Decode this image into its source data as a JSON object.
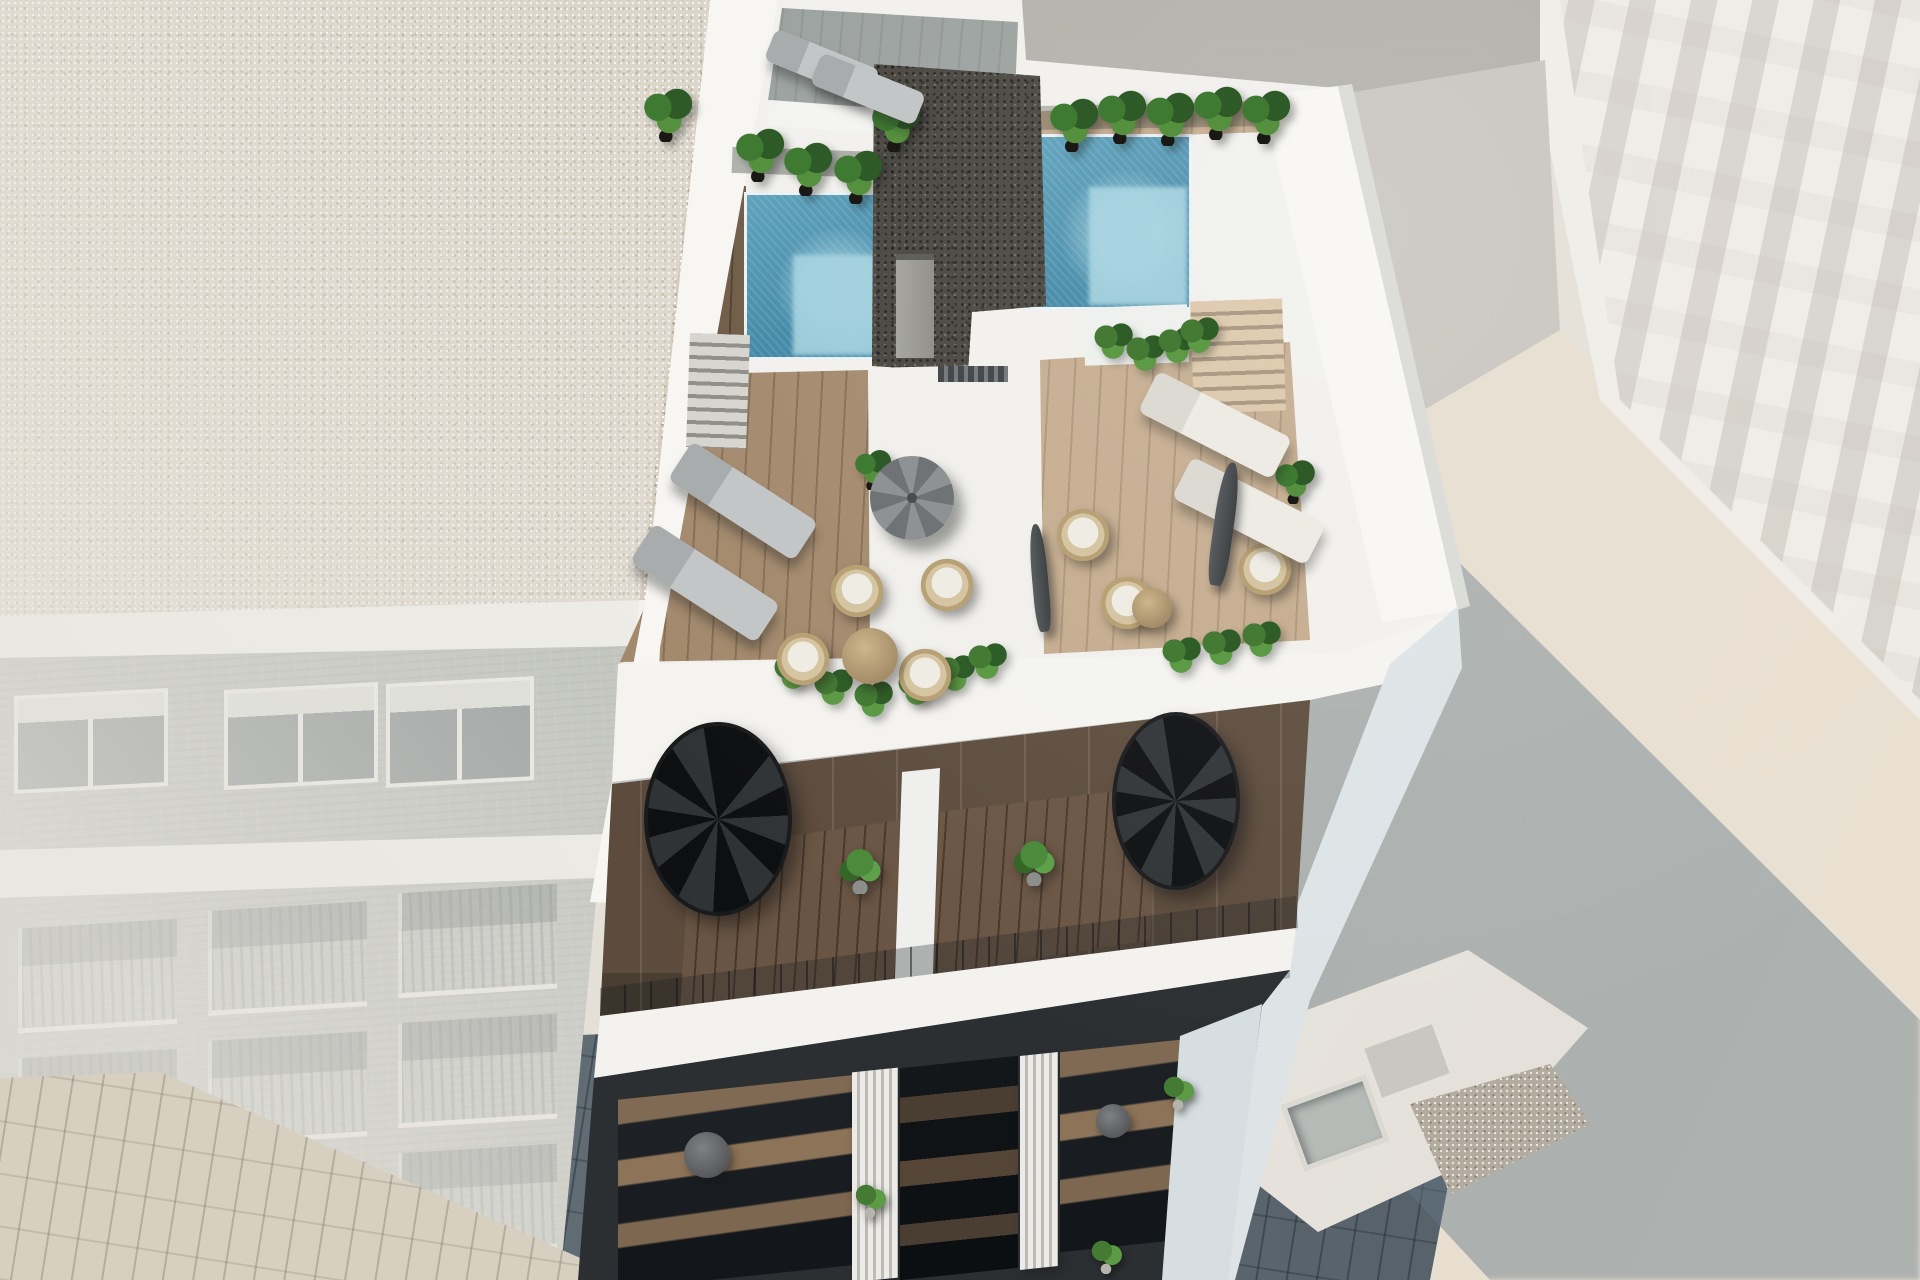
{
  "meta": {
    "title": "Aerial 3D architectural rendering of a modern white apartment building",
    "type": "architectural-visualization",
    "width": 1920,
    "height": 1280
  },
  "palette": {
    "bg": "#e4dfd7",
    "back-wall": "#b2afa9",
    "tan-column": "#e2ae83",
    "right-building": "#efece7",
    "gravel-beige": "#d5ccbe",
    "left-wall": "#97a09a",
    "white-parapet": "#f7f6f3",
    "white-wall": "#f1f0ed",
    "pool-deep": "#3e86a5",
    "pool-light": "#a5d3e0",
    "gravel-dark": "#45423c",
    "wood-left": "#a3896c",
    "wood-right": "#c4ab8d",
    "wood-dark": "#6e5a45",
    "plant-dark": "#2d5a26",
    "plant-mid": "#3e7a32",
    "plant-light": "#55903e",
    "pot-dark": "#191815",
    "lounger-gray": "#c3c6c6",
    "lounger-white": "#edebe4",
    "umbrella-gray": "#8e9295",
    "wicker": "#d6c5a2",
    "cushion": "#efece3",
    "glass-dark": "#26292c",
    "fin-light": "#ecebe7",
    "fin-shade": "#bdbbb6",
    "street": "#5d6973",
    "street-sun": "#d7cfc0",
    "shadow-tint": "rgba(99,119,133,0.45)"
  },
  "scene": {
    "description": "Sunny aerial 3D render of a white residential building: rooftop terrace with two blue plunge pools flanking a dark gravel core roof, wooden sun decks with loungers, wicker chairs, umbrellas and potted palms; penthouse level with two black spiral staircases and planted terraces; glass-fronted balconies below with ribbed white fins; hazy brick apartment block to the left, pale high-rise to the right, and the building's long blue shadow cast across the paved street.",
    "sun": "from upper-left, shadows cast to the lower-right",
    "buildings": {
      "main": {
        "label": "main-building",
        "features": [
          "rooftop terrace",
          "2 swimming pools",
          "dark gravel core roof",
          "wood decks",
          "2 spiral staircases",
          "glass balconies",
          "ribbed white fins"
        ]
      },
      "left": {
        "label": "neighbor-building-left",
        "features": [
          "beige gravel roof",
          "grey-green brick facade",
          "white-framed windows",
          "rows of railed balconies",
          "atmospheric haze"
        ]
      },
      "right_tall": {
        "label": "neighbor-building-right-tall",
        "features": [
          "pale facade with faint window grid"
        ]
      },
      "right_low": {
        "label": "neighbor-building-right-low",
        "features": [
          "sunlit roof",
          "2 skylights",
          "gravel patch"
        ]
      },
      "rear": {
        "label": "rear-wall",
        "features": [
          "grey wall",
          "tan column"
        ]
      }
    },
    "counts": {
      "pools": 2,
      "spiral_staircases": 2,
      "sun_loungers": 6,
      "wicker_chairs": 7,
      "round_tables": 4,
      "umbrellas": 3,
      "potted_palms": 12,
      "bushes": 13,
      "penthouse_plants": 2,
      "balcony_plants": 3,
      "skylights": 2,
      "chimneys": 1
    },
    "items": [
      {
        "type": "palm",
        "x": 640,
        "y": 86
      },
      {
        "type": "palm",
        "x": 732,
        "y": 126
      },
      {
        "type": "palm",
        "x": 780,
        "y": 140
      },
      {
        "type": "palm",
        "x": 830,
        "y": 148
      },
      {
        "type": "palm",
        "x": 868,
        "y": 96
      },
      {
        "type": "palm",
        "x": 1046,
        "y": 96
      },
      {
        "type": "palm",
        "x": 1094,
        "y": 88
      },
      {
        "type": "palm",
        "x": 1142,
        "y": 90
      },
      {
        "type": "palm",
        "x": 1190,
        "y": 84
      },
      {
        "type": "palm",
        "x": 1238,
        "y": 88
      },
      {
        "type": "palm",
        "x": 852,
        "y": 448,
        "w": 42,
        "h": 42
      },
      {
        "type": "palm",
        "x": 1272,
        "y": 458,
        "w": 46,
        "h": 46
      },
      {
        "type": "bush",
        "x": 770,
        "y": 648
      },
      {
        "type": "bush",
        "x": 810,
        "y": 664
      },
      {
        "type": "bush",
        "x": 850,
        "y": 676
      },
      {
        "type": "bush",
        "x": 894,
        "y": 664
      },
      {
        "type": "bush",
        "x": 932,
        "y": 650
      },
      {
        "type": "bush",
        "x": 964,
        "y": 638
      },
      {
        "type": "bush",
        "x": 1090,
        "y": 318
      },
      {
        "type": "bush",
        "x": 1122,
        "y": 330
      },
      {
        "type": "bush",
        "x": 1154,
        "y": 322
      },
      {
        "type": "bush",
        "x": 1176,
        "y": 312
      },
      {
        "type": "bush",
        "x": 1158,
        "y": 632
      },
      {
        "type": "bush",
        "x": 1198,
        "y": 624
      },
      {
        "type": "bush",
        "x": 1238,
        "y": 616
      },
      {
        "type": "pot-plant",
        "x": 836,
        "y": 842
      },
      {
        "type": "pot-plant",
        "x": 1010,
        "y": 834
      },
      {
        "type": "balcony-plant",
        "x": 850,
        "y": 1176
      },
      {
        "type": "balcony-plant",
        "x": 1158,
        "y": 1068
      },
      {
        "type": "balcony-plant",
        "x": 1086,
        "y": 1232
      },
      {
        "type": "wicker-chair",
        "x": 830,
        "y": 564
      },
      {
        "type": "wicker-chair",
        "x": 920,
        "y": 558
      },
      {
        "type": "wicker-chair",
        "x": 898,
        "y": 648
      },
      {
        "type": "wicker-chair",
        "x": 776,
        "y": 632
      },
      {
        "type": "wicker-chair",
        "x": 1056,
        "y": 508
      },
      {
        "type": "wicker-chair",
        "x": 1100,
        "y": 576
      },
      {
        "type": "wicker-chair",
        "x": 1238,
        "y": 542
      },
      {
        "type": "lounger-gray",
        "x": 766,
        "y": 48,
        "w": 112,
        "h": 34,
        "rot": 22
      },
      {
        "type": "lounger-gray",
        "x": 812,
        "y": 72,
        "w": 112,
        "h": 34,
        "rot": 22
      },
      {
        "type": "lounger-gray",
        "x": 668,
        "y": 478,
        "rot": 33
      },
      {
        "type": "lounger-gray",
        "x": 630,
        "y": 560,
        "rot": 33
      },
      {
        "type": "lounger-white",
        "x": 1140,
        "y": 402,
        "rot": 27
      },
      {
        "type": "lounger-white",
        "x": 1174,
        "y": 488,
        "rot": 27
      },
      {
        "type": "table-wood",
        "x": 842,
        "y": 628,
        "d": 56
      },
      {
        "type": "table-wood",
        "x": 1132,
        "y": 588,
        "d": 40
      },
      {
        "type": "table-dark",
        "x": 684,
        "y": 1132,
        "d": 46
      },
      {
        "type": "table-dark",
        "x": 1096,
        "y": 1104,
        "d": 34
      },
      {
        "type": "umbrella-open",
        "x": 870,
        "y": 456,
        "d": 84
      },
      {
        "type": "umbrella-closed",
        "x": 1214,
        "y": 462,
        "w": 20,
        "h": 124,
        "rot": 8
      },
      {
        "type": "umbrella-closed",
        "x": 1032,
        "y": 524,
        "w": 16,
        "h": 108,
        "rot": -5
      }
    ]
  }
}
